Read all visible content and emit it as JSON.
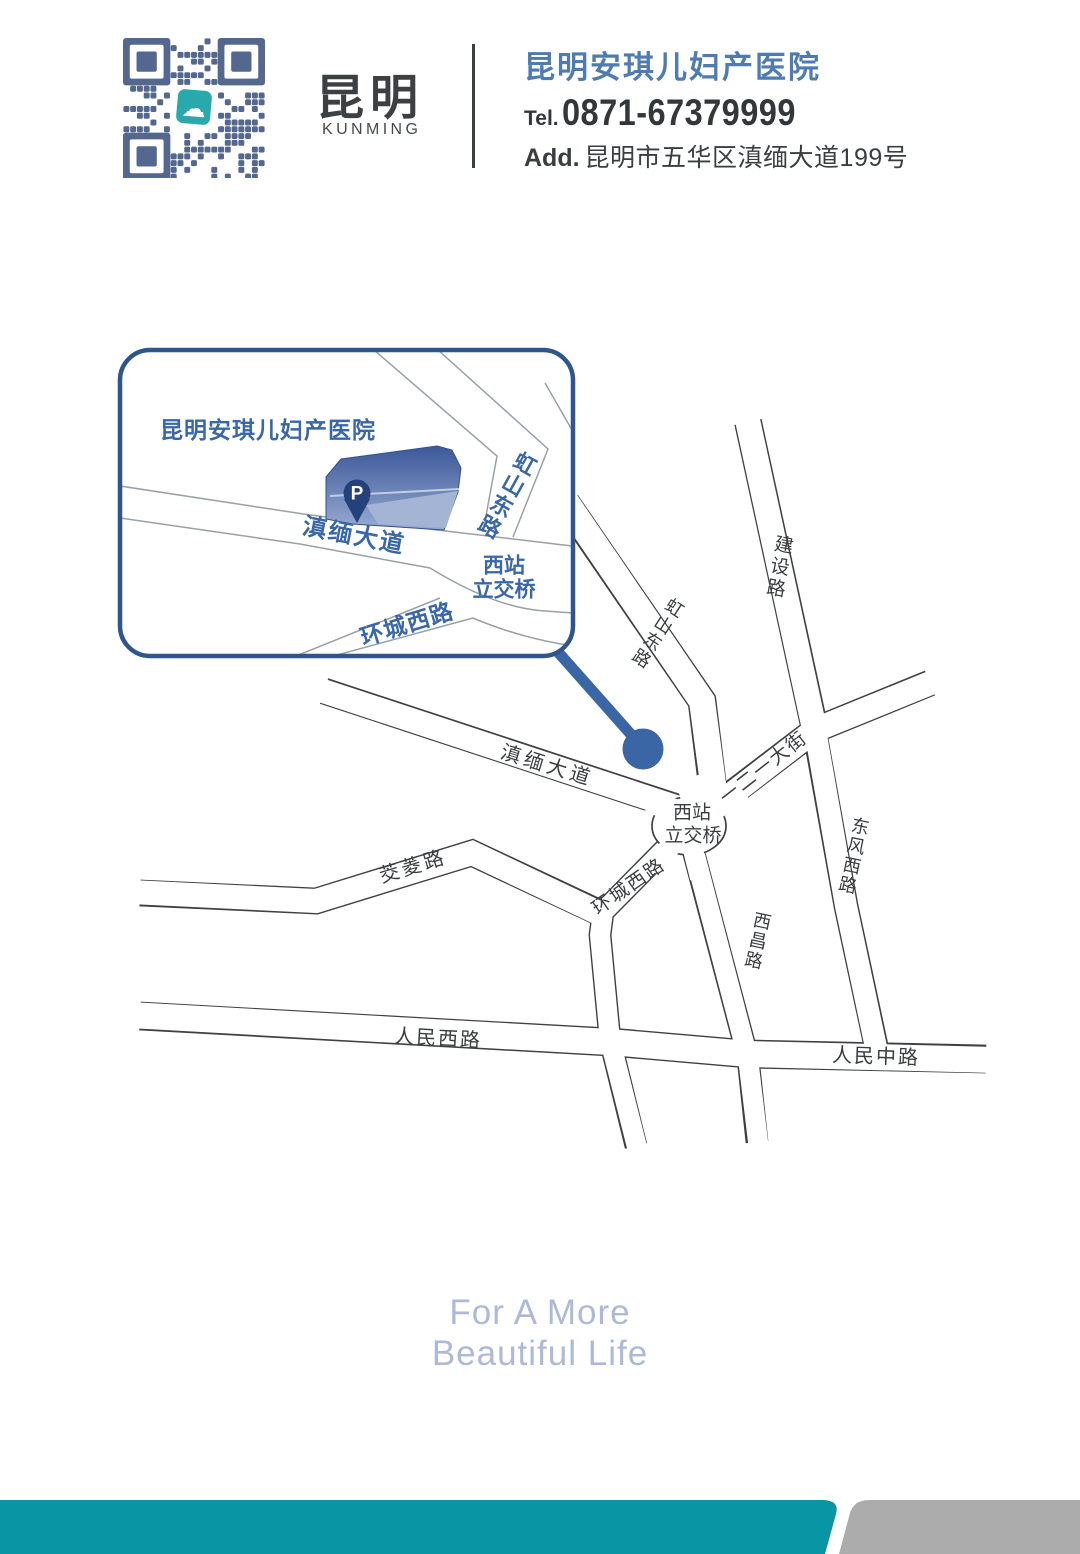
{
  "header": {
    "brand_city": "昆明",
    "brand_city_en": "KUNMING",
    "hospital_name": "昆明安琪儿妇产医院",
    "tel_label": "Tel.",
    "tel_number": "0871-67379999",
    "add_label": "Add.",
    "address": "昆明市五华区滇缅大道199号"
  },
  "inset": {
    "title": "昆明安琪儿妇产医院",
    "parking_label": "P",
    "roads": {
      "dianmian": "滇缅大道",
      "hongshan": "虹山东路",
      "interchange_line1": "西站",
      "interchange_line2": "立交桥",
      "huancheng": "环城西路"
    }
  },
  "map": {
    "roads": {
      "dianmian": "滇缅大道",
      "hongshan": "虹山东路",
      "jianshe": "建设路",
      "yieryi": "一二一大街",
      "dongfeng": "东风西路",
      "xichang": "西昌路",
      "huancheng": "环城西路",
      "jiaoling": "茭菱路",
      "renmin_west": "人民西路",
      "renmin_middle": "人民中路",
      "interchange_line1": "西站",
      "interchange_line2": "立交桥"
    }
  },
  "footer": {
    "slogan_line1": "For A More",
    "slogan_line2": "Beautiful Life"
  },
  "colors": {
    "accent_blue": "#3b66a6",
    "label_blue": "#3a67a8",
    "road_line": "#3f4043",
    "inset_border": "#2e558c",
    "teal_bar": "#0995a3",
    "gray_bar": "#acacac",
    "qr_blue": "#53678f",
    "qr_logo_teal": "#2aa9ad",
    "slogan_blue": "#adbad7"
  }
}
